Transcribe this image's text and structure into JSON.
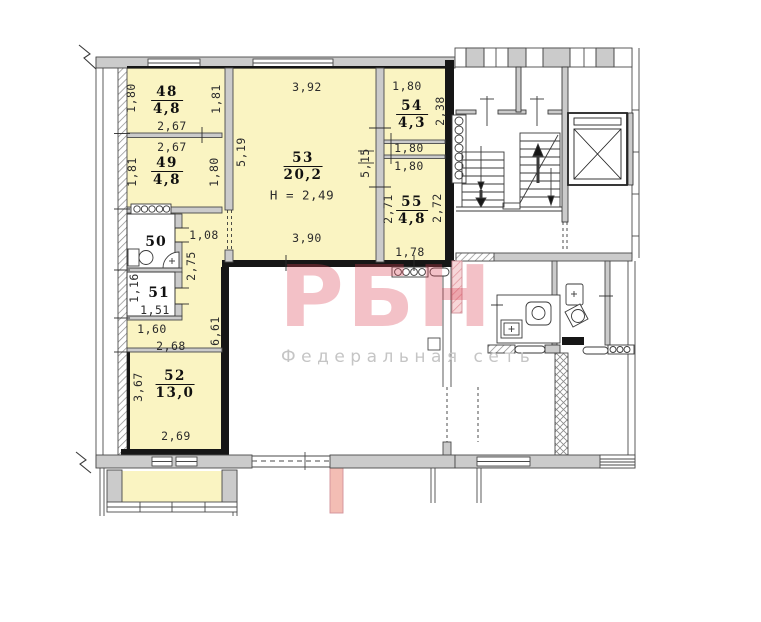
{
  "plan": {
    "watermark": {
      "brand": "РБН",
      "subtitle": "Федеральная сеть"
    },
    "rooms": {
      "r48": {
        "num": "48",
        "area": "4,8"
      },
      "r49": {
        "num": "49",
        "area": "4,8"
      },
      "r50": {
        "num": "50"
      },
      "r51": {
        "num": "51"
      },
      "r52": {
        "num": "52",
        "area": "13,0"
      },
      "r53": {
        "num": "53",
        "area": "20,2",
        "height": "Н = 2,49"
      },
      "r54": {
        "num": "54",
        "area": "4,3"
      },
      "r55": {
        "num": "55",
        "area": "4,8"
      }
    },
    "dims": {
      "d48_left": "1,80",
      "d48_right": "1,81",
      "d48_width": "2,67",
      "d49_width": "2,67",
      "d49_left": "1,81",
      "d49_right": "1,80",
      "d53_left": "5,19",
      "d53_top": "3,92",
      "d53_bottom": "3,90",
      "d53_right": "5,15",
      "d54_top": "1,80",
      "d54_right": "2,38",
      "d54_bottom": "1,80",
      "d55_top": "1,80",
      "d55_left": "2,71",
      "d55_right": "2,72",
      "d55_bottom": "1,78",
      "d50_door": "1,08",
      "dhall_upper": "2,75",
      "d51_left": "1,16",
      "d51_bottom": "1,51",
      "dhall_1": "1,60",
      "dhall_2": "2,68",
      "dhall_len": "6,61",
      "d52_left": "3,67",
      "d52_bottom": "2,69"
    }
  }
}
